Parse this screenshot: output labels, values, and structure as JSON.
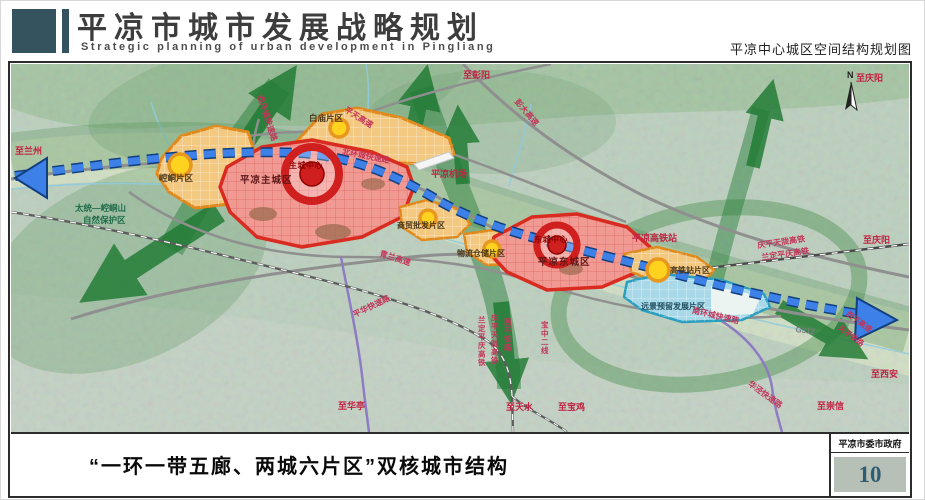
{
  "header": {
    "title_cn": "平凉市城市发展战略规划",
    "title_en": "Strategic planning of urban development in Pingliang",
    "map_subtitle": "平凉中心城区空间结构规划图"
  },
  "footer": {
    "caption": "“一环一带五廊、两城六片区”双核城市结构",
    "agency": "平凉市委市政府",
    "page_number": "10"
  },
  "colors": {
    "header_block": "#35535f",
    "zone_red_fill": "#f19a93",
    "zone_red_border": "#d92b1f",
    "zone_orange_fill": "#f3c880",
    "zone_orange_border": "#e0891c",
    "zone_blue_fill": "#a9d9e9",
    "zone_blue_border": "#2b9fbf",
    "axis_blue": "#3c80e8",
    "corridor_green": "#1f7a33",
    "node_yellow": "#ffd21f",
    "page_number_box": "#b7c0b6"
  },
  "map": {
    "compass": "N",
    "labels": {
      "to_lanzhou": "至兰州",
      "to_pengyang": "至彭阳",
      "to_qingyang_top": "至庆阳",
      "to_qingyang_east": "至庆阳",
      "to_xian": "至西安",
      "to_chongxin": "至崇信",
      "to_tianshui": "至天水",
      "to_baoji": "至宝鸡",
      "to_huating": "至华亭",
      "nature_reserve_line1": "太统—崆峒山",
      "nature_reserve_line2": "自然保护区",
      "airport": "平凉机场",
      "hsr_station": "平凉高铁站"
    },
    "zones": {
      "kongtong": "崆峒片区",
      "baimiao": "白庙片区",
      "trade": "商贸批发片区",
      "logistics": "物流仓储片区",
      "hsr": "高铁站片区",
      "reserve": "远景预留发展片区",
      "main_city": "平凉主城区",
      "east_city": "平凉东城区"
    },
    "centers": {
      "main": "主城中心",
      "east": "东城中心"
    },
    "roads": {
      "ring_west": "西环城快速路",
      "ring_north": "北环城快速路",
      "ring_south": "南环城快速路",
      "pingtian": "平天高速",
      "pengda": "彭大高速",
      "qinglan": "青兰高速",
      "pinghua": "平华快速路",
      "huajing": "华泾快速路",
      "g312": "G312",
      "xiping_expwy": "西平高速"
    },
    "rails": {
      "qptl": "庆平天陇高铁",
      "ldpq": "兰定平庆高铁",
      "qptl_v": "庆平天陇高铁",
      "ldpq_v": "兰定平庆高铁",
      "xiping": "西平铁路",
      "baozhong": "宝中二线",
      "tianping": "天平铁路"
    }
  }
}
